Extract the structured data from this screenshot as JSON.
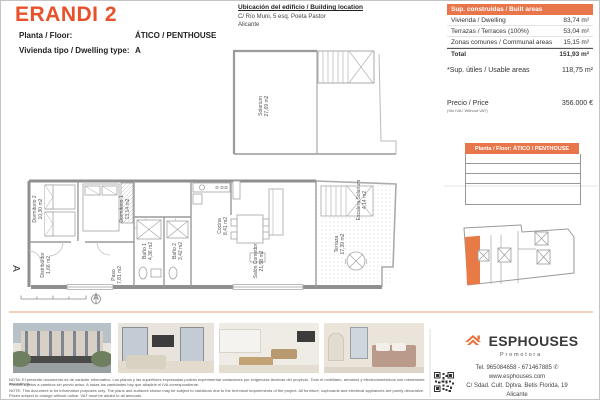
{
  "accent": "#e8764a",
  "header": {
    "title": "ERANDI 2",
    "floor_label": "Planta / Floor:",
    "floor_value": "ÁTICO / PENTHOUSE",
    "type_label": "Vivienda tipo / Dwelling type:",
    "type_value": "A"
  },
  "location": {
    "heading": "Ubicación del edificio / Building location",
    "address": "C/ Río Muni, 5 esq. Poeta Pastor",
    "city": "Alicante"
  },
  "built_areas": {
    "header": "Sup. construidas / Built areas",
    "rows": [
      {
        "label": "Vivienda / Dwelling",
        "value": "83,74 m²"
      },
      {
        "label": "Terrazas / Terraces (100%)",
        "value": "53,04 m²"
      },
      {
        "label": "Zonas comunes / Communal areas",
        "value": "15,15 m²"
      }
    ],
    "total_label": "Total",
    "total_value": "151,93 m²"
  },
  "usable": {
    "label": "*Sup. útiles / Usable areas",
    "value": "118,75 m²"
  },
  "price": {
    "label": "Precio / Price",
    "vat_note": "(Sin IVA / Without VAT)",
    "value": "356.000 €"
  },
  "floor_bar": "Planta / Floor: ÁTICO / PENTHOUSE",
  "plan": {
    "section_label": "A",
    "solarium": {
      "name": "Solarium",
      "area": "27,69 m2"
    },
    "rooms": [
      {
        "name": "Dormitorio 2",
        "area": "10,30 m2"
      },
      {
        "name": "Dormitorio 1",
        "area": "13,14 m2"
      },
      {
        "name": "Distribuidor",
        "area": "1,66 m2"
      },
      {
        "name": "Paso",
        "area": "7,81 m2"
      },
      {
        "name": "Baño 1",
        "area": "4,36 m2"
      },
      {
        "name": "Baño 2",
        "area": "3,42 m2"
      },
      {
        "name": "Cocina",
        "area": "8,41 m2"
      },
      {
        "name": "Salón Comedor",
        "area": "21,58 m2"
      },
      {
        "name": "Terraza",
        "area": "17,39 m2"
      },
      {
        "name": "Escalera Solarium",
        "area": "4,14 m2"
      }
    ]
  },
  "photos": [
    "building-exterior",
    "living-room",
    "kitchen-dining",
    "bedroom"
  ],
  "footer": {
    "brand": "ESPHOUSES",
    "tagline": "Promotora",
    "tel": "Tel. 965084658 - 671467885",
    "web": "www.esphouses.com",
    "address": "C/ Sdad. Cult. Dptva. Betis Florida, 19",
    "city": "Alicante"
  },
  "disclaimer": {
    "line1": "NOTA: El presente documento es de carácter informativo. Los planos y las superficies expresadas podrán experimentar variaciones por exigencias técnicas del proyecto. Todo el mobiliario, armarios y electrodomésticos son meramente decorativos.",
    "line2": "Precios sujetos a cambios sin previo aviso. A todas las cantidades hay que añadirle el IVA correspondiente.",
    "line3": "NOTE: This document is for information purposes only. The plans and surfaces shown may be subject to variations due to the technical requirements of the project. All furniture, cupboards and electrical appliances are purely decorative.",
    "line4": "Prices subject to change without notice. VAT must be added to all amounts."
  }
}
